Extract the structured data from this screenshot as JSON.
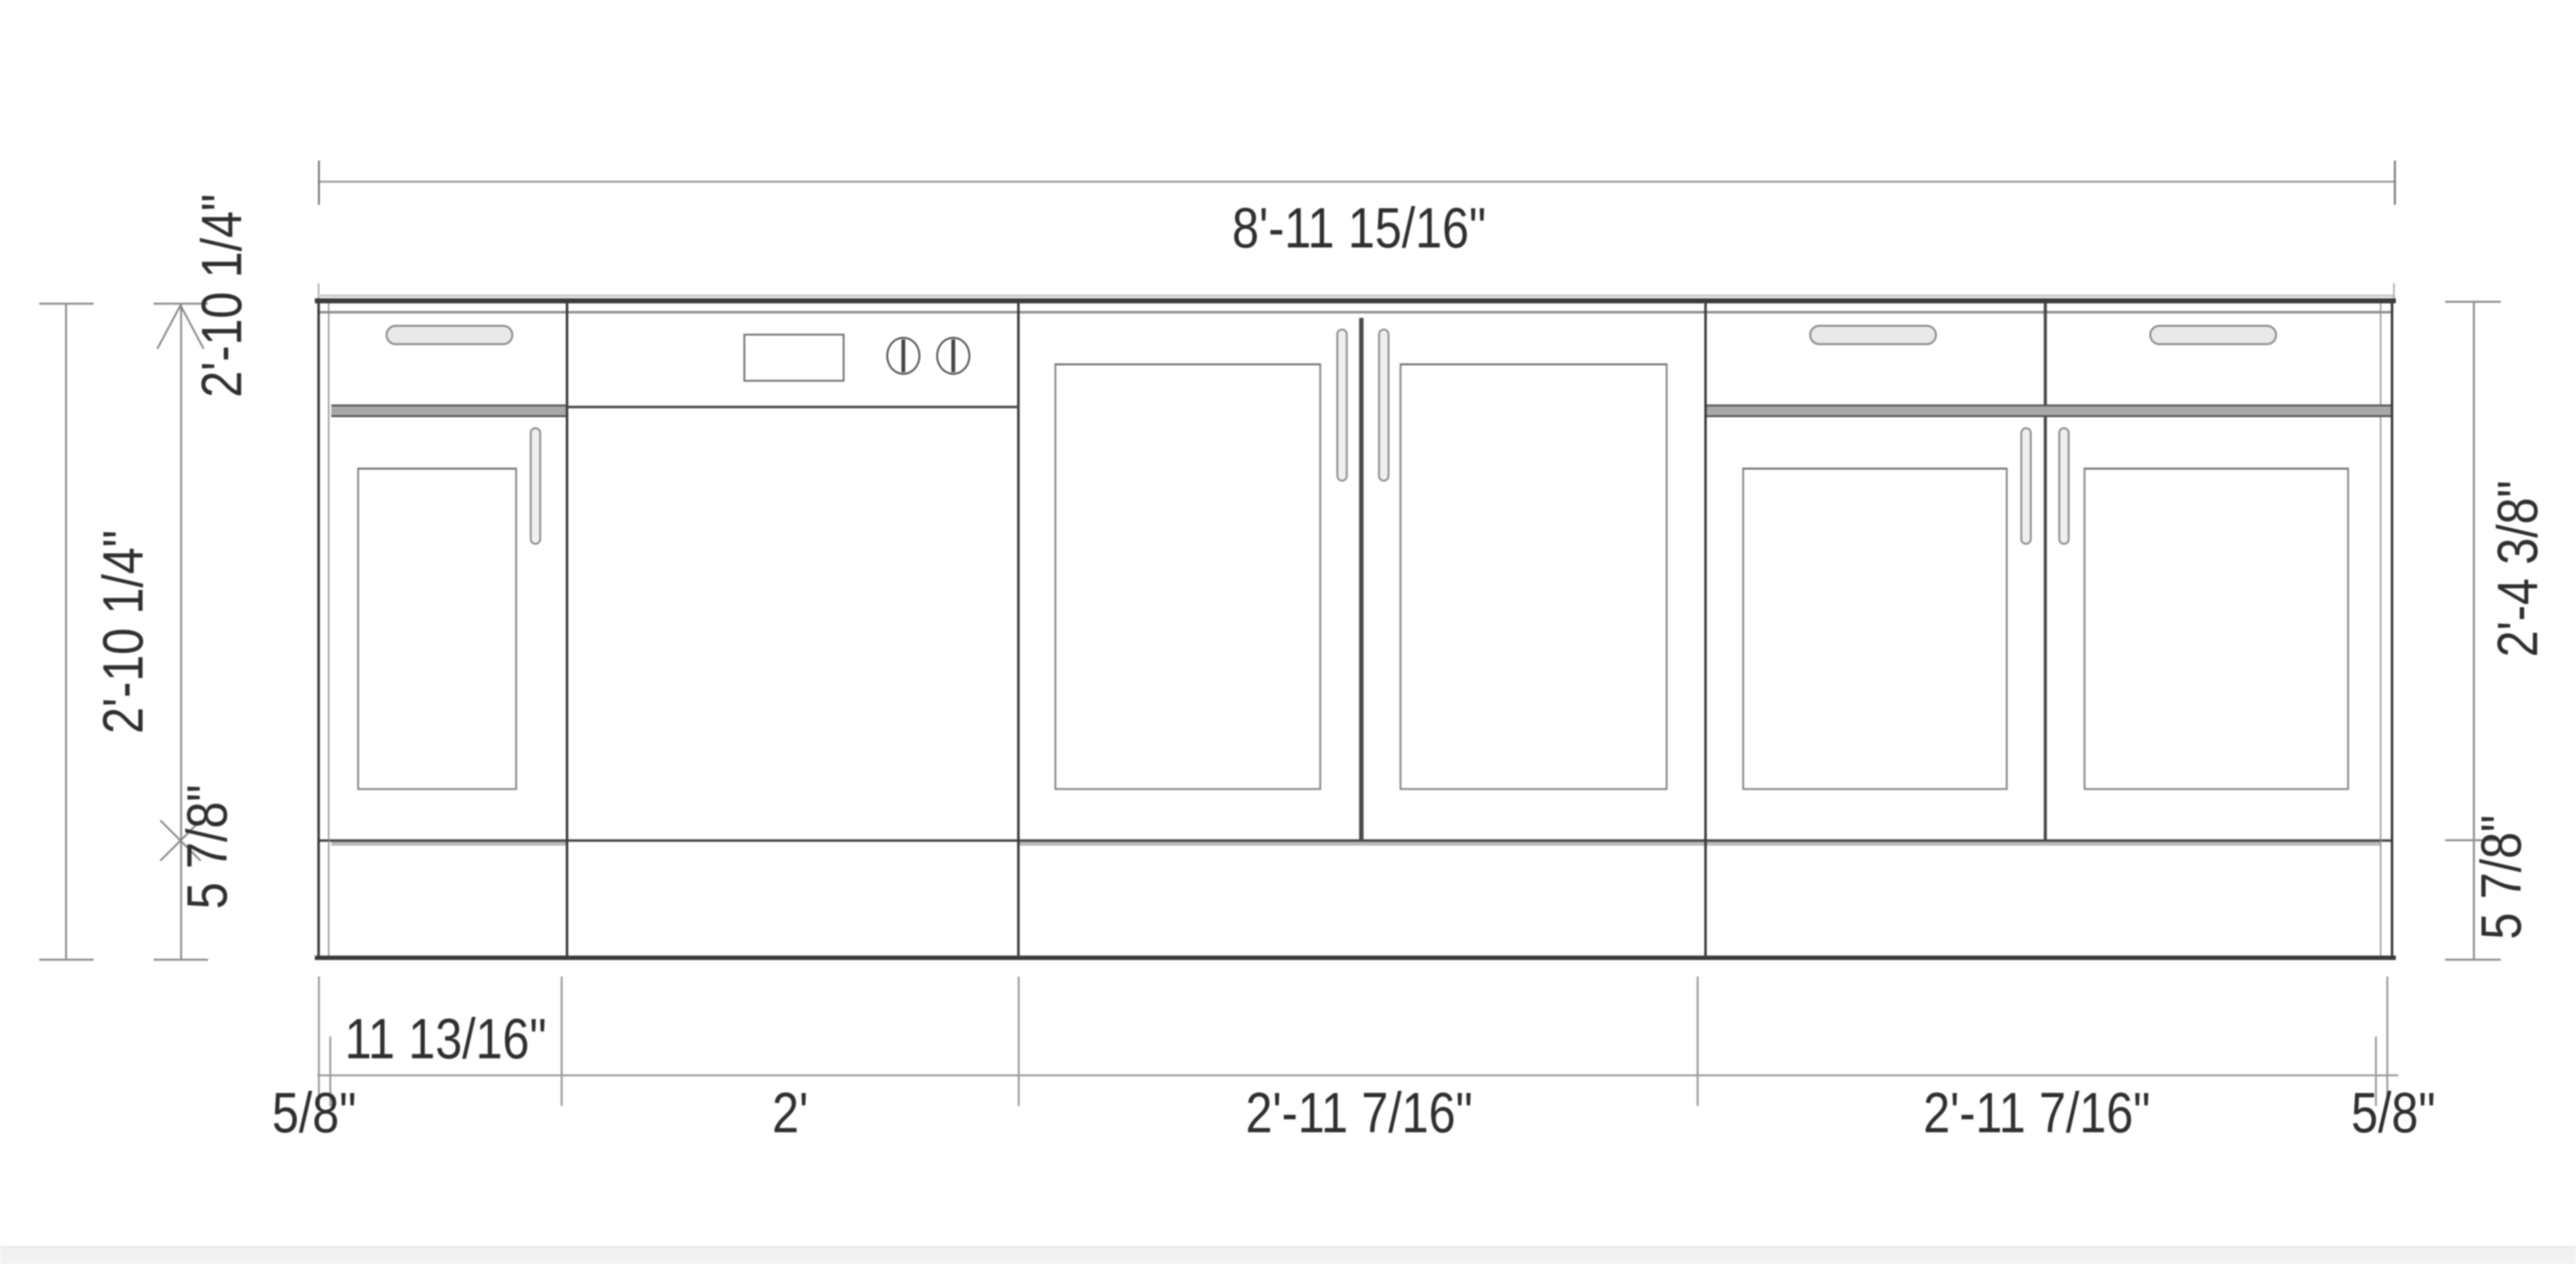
{
  "page": {
    "background": "#ffffff",
    "bottom_strip_color": "#f1f1f1"
  },
  "colors": {
    "line_dark": "#3b3b3b",
    "line_mid": "#8a8a8a",
    "line_light": "#c9c9c9",
    "dimension_line": "#999999",
    "text": "#2f2f2f",
    "handle_fill": "#e9e9e9"
  },
  "labels": {
    "overall_width": "8'-11 15/16\"",
    "left_total_height": "2'-10 1/4\"",
    "left_cabinet_height": "2'-10 1/4\"",
    "left_toe_kick_height": "5 7/8\"",
    "right_door_height": "2'-4 3/8\"",
    "right_toe_kick_height": "5 7/8\"",
    "width_left_end_panel": "5/8\"",
    "width_cabinet_1": "11 13/16\"",
    "width_dishwasher": "2'",
    "width_cabinet_3": "2'-11 7/16\"",
    "width_cabinet_4": "2'-11 7/16\"",
    "width_right_end_panel": "5/8\""
  }
}
